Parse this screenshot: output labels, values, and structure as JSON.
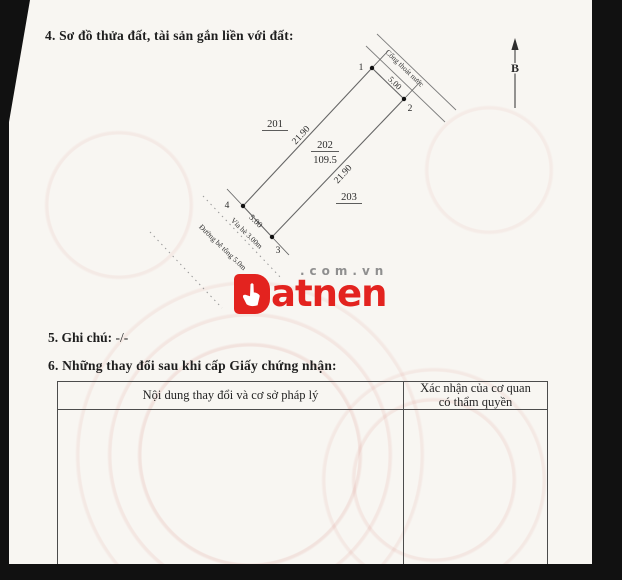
{
  "sections": {
    "section4_title": "4. Sơ đồ thửa đất, tài sản gắn liền với đất:",
    "section5_label": "5. Ghi chú:",
    "section5_value": "-/-",
    "section6_title": "6. Những thay đổi sau khi cấp Giấy chứng nhận:"
  },
  "diagram": {
    "north_label": "B",
    "parcel_number": "202",
    "parcel_area": "109.5",
    "adjacent_parcel_left": "201",
    "adjacent_parcel_right": "203",
    "edge_top_length": "5.00",
    "edge_left_length": "21.90",
    "edge_right_length": "21.90",
    "edge_bottom_length": "5.00",
    "vertices": {
      "v1": "1",
      "v2": "2",
      "v3": "3",
      "v4": "4"
    },
    "drain_label": "Cống thoát nước",
    "sidewalk_label": "Vỉa hè 3.00m",
    "road_label": "Đường bê tông 5.0m"
  },
  "watermark": {
    "brand": "Datnen",
    "brand_rest": "atnen",
    "domain": ".com.vn",
    "brand_color": "#e3231f"
  },
  "table": {
    "col1_header": "Nội dung thay đổi và cơ sở pháp lý",
    "col2_header_line1": "Xác nhận của cơ quan",
    "col2_header_line2": "có thẩm quyền"
  }
}
